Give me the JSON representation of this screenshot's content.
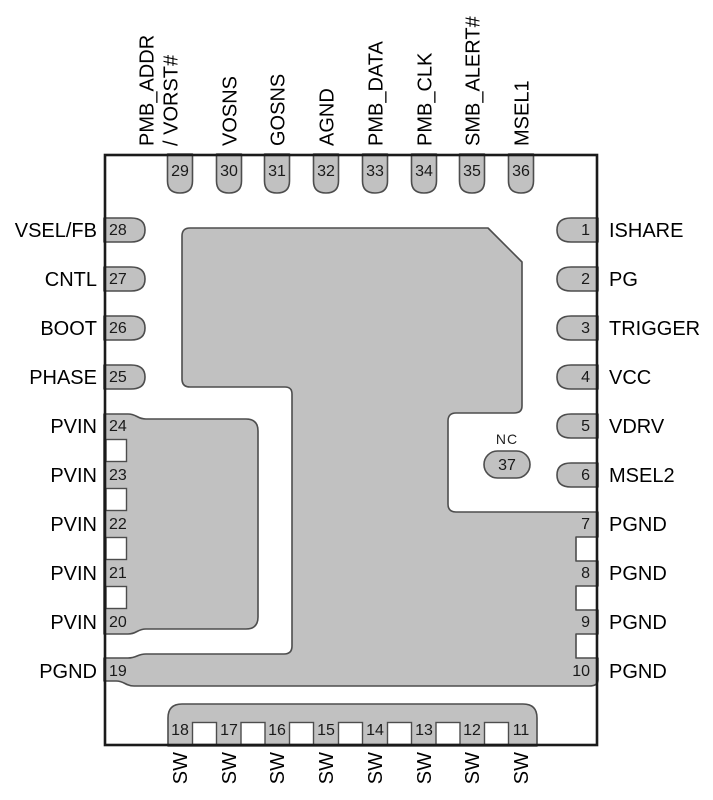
{
  "diagram": {
    "type": "ic-package-pinout",
    "colors": {
      "pad_fill": "#c1c1c1",
      "pad_stroke": "#4d4d4d",
      "package_outline": "#1a1a1a",
      "text": "#000000",
      "background": "#ffffff"
    },
    "center_pin": {
      "num": "37",
      "label": "NC"
    },
    "pins": {
      "top": [
        {
          "num": "29",
          "label_line1": "PMB_ADDR",
          "label_line2": "/ VORST#"
        },
        {
          "num": "30",
          "label": "VOSNS"
        },
        {
          "num": "31",
          "label": "GOSNS"
        },
        {
          "num": "32",
          "label": "AGND"
        },
        {
          "num": "33",
          "label": "PMB_DATA"
        },
        {
          "num": "34",
          "label": "PMB_CLK"
        },
        {
          "num": "35",
          "label": "SMB_ALERT#"
        },
        {
          "num": "36",
          "label": "MSEL1"
        }
      ],
      "left": [
        {
          "num": "28",
          "label": "VSEL/FB"
        },
        {
          "num": "27",
          "label": "CNTL"
        },
        {
          "num": "26",
          "label": "BOOT"
        },
        {
          "num": "25",
          "label": "PHASE"
        },
        {
          "num": "24",
          "label": "PVIN"
        },
        {
          "num": "23",
          "label": "PVIN"
        },
        {
          "num": "22",
          "label": "PVIN"
        },
        {
          "num": "21",
          "label": "PVIN"
        },
        {
          "num": "20",
          "label": "PVIN"
        },
        {
          "num": "19",
          "label": "PGND"
        }
      ],
      "right": [
        {
          "num": "1",
          "label": "ISHARE"
        },
        {
          "num": "2",
          "label": "PG"
        },
        {
          "num": "3",
          "label": "TRIGGER"
        },
        {
          "num": "4",
          "label": "VCC"
        },
        {
          "num": "5",
          "label": "VDRV"
        },
        {
          "num": "6",
          "label": "MSEL2"
        },
        {
          "num": "7",
          "label": "PGND"
        },
        {
          "num": "8",
          "label": "PGND"
        },
        {
          "num": "9",
          "label": "PGND"
        },
        {
          "num": "10",
          "label": "PGND"
        }
      ],
      "bottom": [
        {
          "num": "18",
          "label": "SW"
        },
        {
          "num": "17",
          "label": "SW"
        },
        {
          "num": "16",
          "label": "SW"
        },
        {
          "num": "15",
          "label": "SW"
        },
        {
          "num": "14",
          "label": "SW"
        },
        {
          "num": "13",
          "label": "SW"
        },
        {
          "num": "12",
          "label": "SW"
        },
        {
          "num": "11",
          "label": "SW"
        }
      ]
    }
  }
}
